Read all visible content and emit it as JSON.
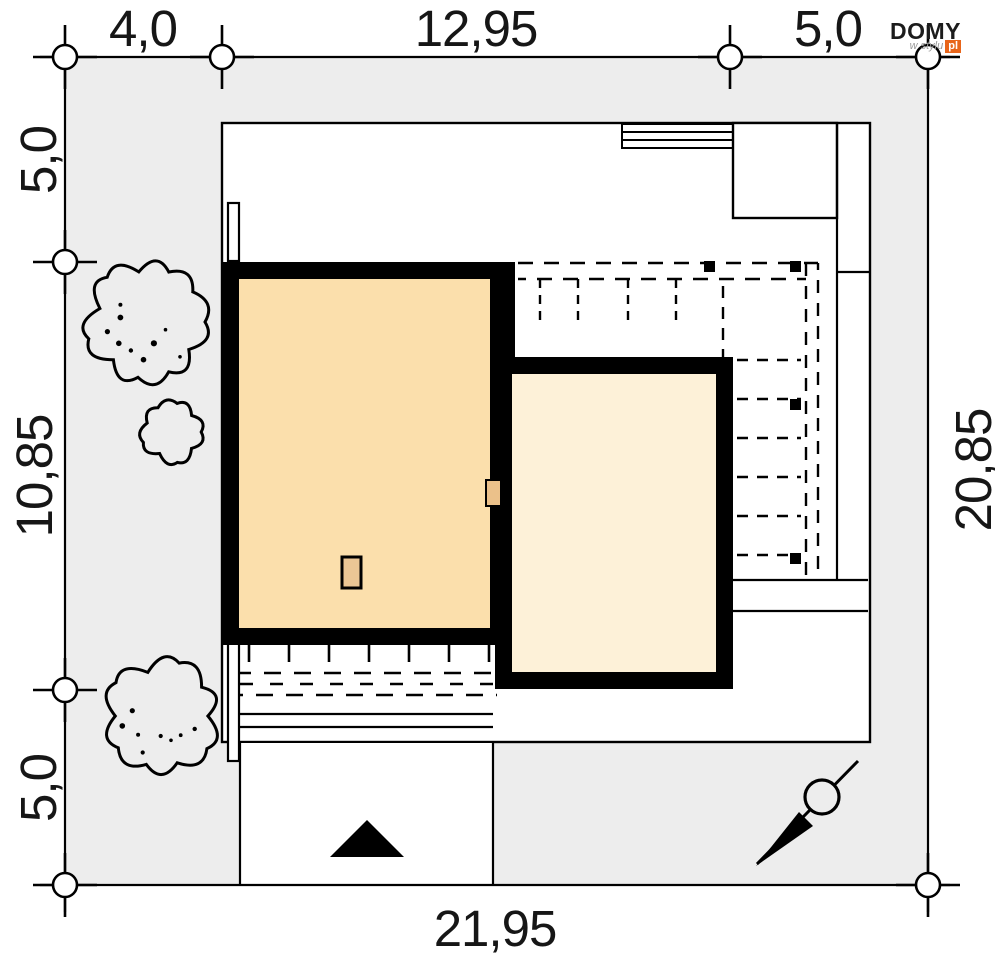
{
  "logo": {
    "name": "DOMY",
    "tagline": "w stylu",
    "tld": "pl"
  },
  "dimensions": {
    "top": [
      "4,0",
      "12,95",
      "5,0"
    ],
    "left": [
      "5,0",
      "10,85",
      "5,0"
    ],
    "right": [
      "20,85"
    ],
    "bottom": [
      "21,95"
    ]
  },
  "colors": {
    "plot_gray": "#ededed",
    "envelope_white": "#ffffff",
    "house_fill": "#fbdfac",
    "annex_fill": "#fdf1d8",
    "door_fill": "#ebc18a",
    "chimney_fill": "#ebc695",
    "line_black": "#000000",
    "logo_orange": "#e8651a"
  },
  "plan": {
    "plot": {
      "width_m": "21,95",
      "height_m": "20,85"
    },
    "trees": [
      {
        "cx": 146,
        "cy": 322,
        "r": 60,
        "dots": 9
      },
      {
        "cx": 172,
        "cy": 432,
        "r": 31,
        "dots": 0
      },
      {
        "cx": 162,
        "cy": 716,
        "r": 57,
        "dots": 8
      }
    ],
    "compass": {
      "cx": 822,
      "cy": 797,
      "r": 17
    },
    "entrance_arrow": {
      "apex_x": 367,
      "apex_y": 820,
      "base_y": 857,
      "half_width": 37
    },
    "icons": {
      "north_arrow": "compass-needle",
      "entrance": "filled-triangle-up",
      "tree": "scalloped-circle"
    }
  }
}
